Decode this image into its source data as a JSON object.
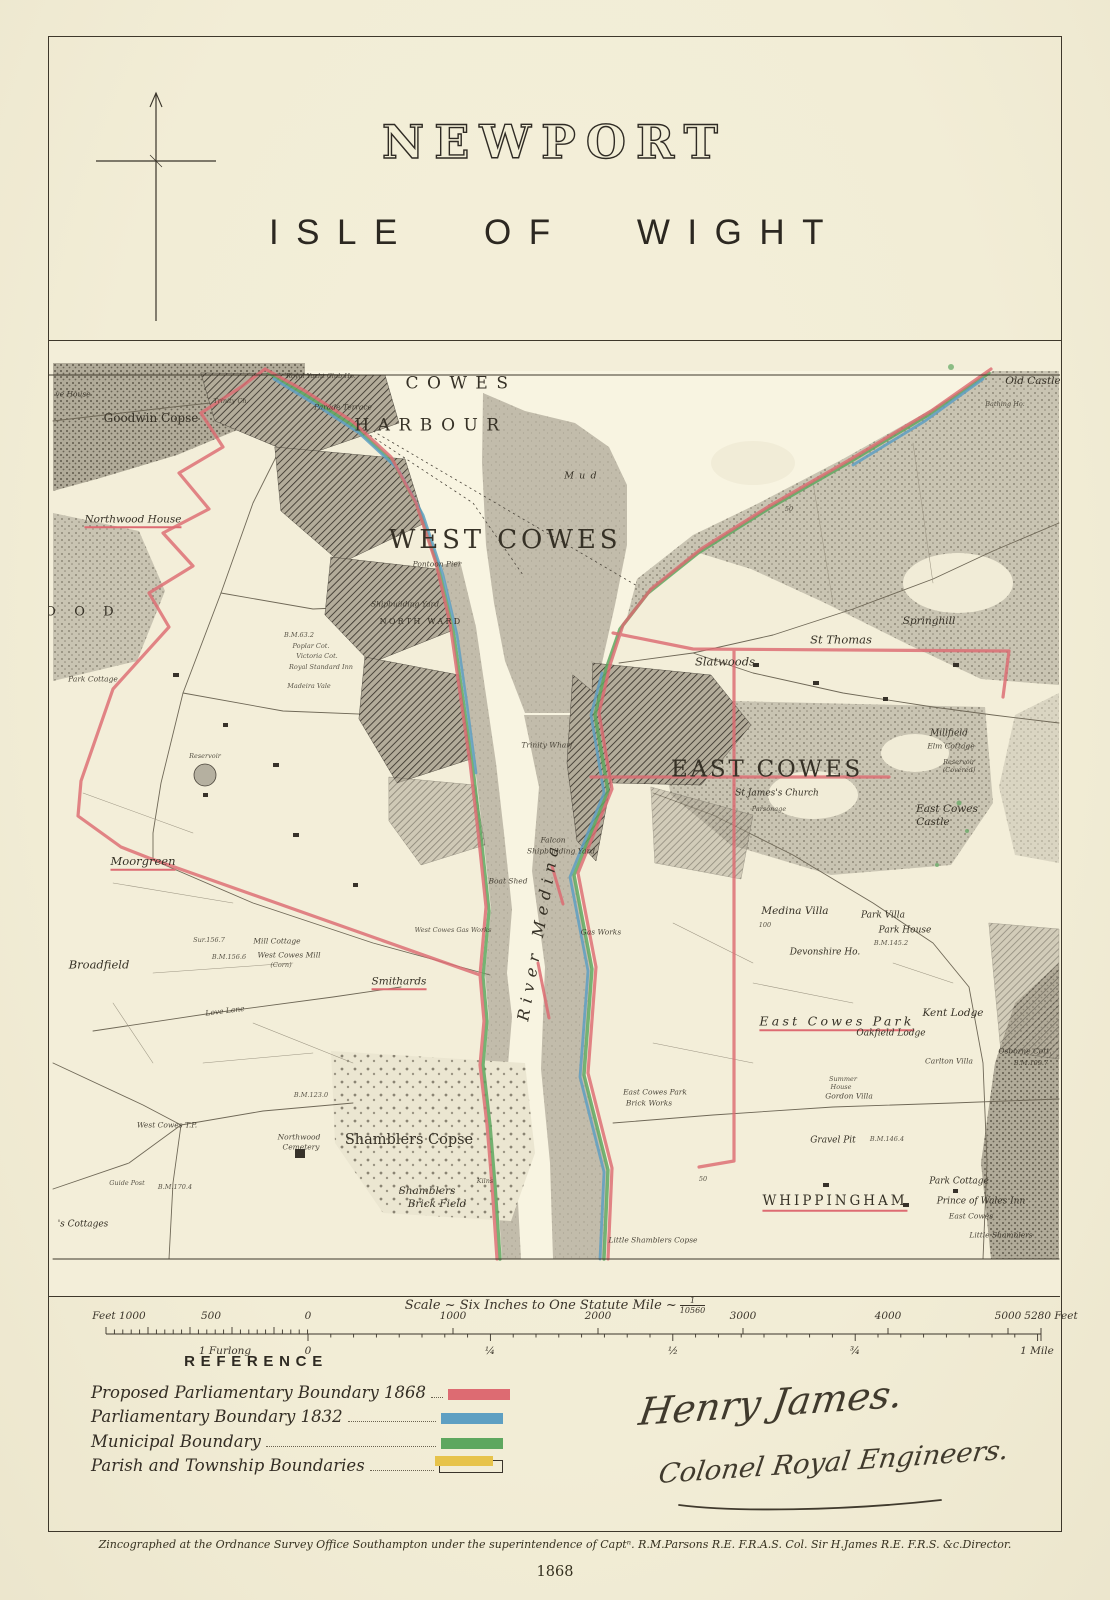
{
  "title_block": {
    "title": "NEWPORT",
    "subtitle": "ISLE OF WIGHT"
  },
  "map": {
    "colors": {
      "red": "#dd6b72",
      "blue": "#5e9fc2",
      "green": "#5ea75f",
      "yellow": "#e7c34a",
      "ink": "#3a342a",
      "water": "#f8f4e1",
      "mud": "#c2bcab",
      "woodland": "#c9c4b2"
    },
    "labels": [
      {
        "text": "Royal Yacht Club Ho.",
        "x": 268,
        "y": 13,
        "cls": "t6"
      },
      {
        "text": "Parade Terrace",
        "x": 290,
        "y": 44,
        "cls": "t7"
      },
      {
        "text": "COWES",
        "x": 408,
        "y": 21,
        "cls": "big17"
      },
      {
        "text": "HARBOUR",
        "x": 378,
        "y": 63,
        "cls": "big17"
      },
      {
        "text": "Mud",
        "x": 530,
        "y": 113,
        "cls": "t8s"
      },
      {
        "text": "WEST COWES",
        "x": 452,
        "y": 177,
        "cls": "big27"
      },
      {
        "text": "Pontoon Pier",
        "x": 384,
        "y": 201,
        "cls": "t7"
      },
      {
        "text": "Shipbuilding Yard",
        "x": 352,
        "y": 241,
        "cls": "t7"
      },
      {
        "text": "NORTH WARD",
        "x": 368,
        "y": 259,
        "cls": "cap8"
      },
      {
        "text": "B.M.63.2",
        "x": 246,
        "y": 272,
        "cls": "t6"
      },
      {
        "text": "Poplar Cot.",
        "x": 258,
        "y": 283,
        "cls": "t6"
      },
      {
        "text": "Victoria Cot.",
        "x": 264,
        "y": 293,
        "cls": "t6"
      },
      {
        "text": "Royal Standard Inn",
        "x": 268,
        "y": 304,
        "cls": "t6"
      },
      {
        "text": "Madeira Vale",
        "x": 256,
        "y": 323,
        "cls": "t6"
      },
      {
        "text": "Old Castle",
        "x": 980,
        "y": 18,
        "cls": "it10"
      },
      {
        "text": "Bathing Ho.",
        "x": 952,
        "y": 41,
        "cls": "t6"
      },
      {
        "text": "ve House",
        "x": 20,
        "y": 31,
        "cls": "t7"
      },
      {
        "text": "Goodwin Copse",
        "x": 98,
        "y": 55,
        "cls": "md12"
      },
      {
        "text": "Trinity Ch.",
        "x": 178,
        "y": 38,
        "cls": "t6"
      },
      {
        "text": "Northwood House",
        "x": 80,
        "y": 158,
        "cls": "it10",
        "u": 1
      },
      {
        "text": "O O D",
        "x": 30,
        "y": 249,
        "cls": "md13sp"
      },
      {
        "text": "Park Cottage",
        "x": 40,
        "y": 316,
        "cls": "t7"
      },
      {
        "text": "Reservoir",
        "x": 152,
        "y": 393,
        "cls": "t6"
      },
      {
        "text": "Moorgreen",
        "x": 90,
        "y": 500,
        "cls": "it11",
        "u": 1
      },
      {
        "text": "Broadfield",
        "x": 46,
        "y": 602,
        "cls": "it11"
      },
      {
        "text": "Sur.156.7",
        "x": 156,
        "y": 577,
        "cls": "t6"
      },
      {
        "text": "Mill Cottage",
        "x": 224,
        "y": 578,
        "cls": "t7"
      },
      {
        "text": "B.M.156.6",
        "x": 176,
        "y": 594,
        "cls": "t6"
      },
      {
        "text": "West Cowes Mill",
        "x": 236,
        "y": 592,
        "cls": "t7"
      },
      {
        "text": "(Corn)",
        "x": 228,
        "y": 602,
        "cls": "t6"
      },
      {
        "text": "Smithards",
        "x": 346,
        "y": 620,
        "cls": "it10",
        "u": 1
      },
      {
        "text": "Love Lane",
        "x": 172,
        "y": 648,
        "cls": "t7",
        "rot": -7
      },
      {
        "text": "West Cowes T.P.",
        "x": 114,
        "y": 762,
        "cls": "t7"
      },
      {
        "text": "B.M.123.0",
        "x": 258,
        "y": 732,
        "cls": "t6"
      },
      {
        "text": "Guide Post",
        "x": 74,
        "y": 820,
        "cls": "t6"
      },
      {
        "text": "B.M.170.4",
        "x": 122,
        "y": 824,
        "cls": "t6"
      },
      {
        "text": "Shamblers Copse",
        "x": 356,
        "y": 777,
        "cls": "md14"
      },
      {
        "text": "Northwood",
        "x": 246,
        "y": 774,
        "cls": "t7"
      },
      {
        "text": "Cemetery",
        "x": 248,
        "y": 784,
        "cls": "t7"
      },
      {
        "text": "Shamblers",
        "x": 374,
        "y": 828,
        "cls": "it10"
      },
      {
        "text": "Brick Field",
        "x": 384,
        "y": 841,
        "cls": "it10"
      },
      {
        "text": "Kilns",
        "x": 432,
        "y": 818,
        "cls": "t6"
      },
      {
        "text": "'s Cottages",
        "x": 30,
        "y": 862,
        "cls": "it9"
      },
      {
        "text": "Little Shamblers Copse",
        "x": 600,
        "y": 877,
        "cls": "t7"
      },
      {
        "text": "River Medina",
        "x": 486,
        "y": 568,
        "cls": "riv",
        "rot": -80
      },
      {
        "text": "Trinity Wharf",
        "x": 494,
        "y": 382,
        "cls": "t7"
      },
      {
        "text": "Falcon",
        "x": 500,
        "y": 477,
        "cls": "t7"
      },
      {
        "text": "Shipbuilding Yard",
        "x": 508,
        "y": 488,
        "cls": "t7"
      },
      {
        "text": "Boat Shed",
        "x": 455,
        "y": 518,
        "cls": "t7"
      },
      {
        "text": "West Cowes Gas Works",
        "x": 400,
        "y": 567,
        "cls": "t6"
      },
      {
        "text": "Gas Works",
        "x": 548,
        "y": 569,
        "cls": "t7"
      },
      {
        "text": "EAST COWES",
        "x": 714,
        "y": 407,
        "cls": "big24"
      },
      {
        "text": "St James's Church",
        "x": 724,
        "y": 431,
        "cls": "it9"
      },
      {
        "text": "Parsonage",
        "x": 716,
        "y": 446,
        "cls": "t6"
      },
      {
        "text": "Slatwoods",
        "x": 672,
        "y": 299,
        "cls": "it11"
      },
      {
        "text": "St Thomas",
        "x": 788,
        "y": 277,
        "cls": "it11"
      },
      {
        "text": "Springhill",
        "x": 876,
        "y": 258,
        "cls": "it10"
      },
      {
        "text": "Millfield",
        "x": 896,
        "y": 371,
        "cls": "it9"
      },
      {
        "text": "Elm Cottage",
        "x": 898,
        "y": 383,
        "cls": "t7"
      },
      {
        "text": "Reservoir",
        "x": 906,
        "y": 399,
        "cls": "t6"
      },
      {
        "text": "(Covered)",
        "x": 906,
        "y": 407,
        "cls": "t6"
      },
      {
        "text": "East Cowes",
        "x": 894,
        "y": 446,
        "cls": "it10"
      },
      {
        "text": "Castle",
        "x": 880,
        "y": 459,
        "cls": "it10"
      },
      {
        "text": "50",
        "x": 736,
        "y": 146,
        "cls": "t6"
      },
      {
        "text": "Medina Villa",
        "x": 742,
        "y": 548,
        "cls": "it10"
      },
      {
        "text": "100",
        "x": 712,
        "y": 562,
        "cls": "t6"
      },
      {
        "text": "Park Villa",
        "x": 830,
        "y": 553,
        "cls": "it9"
      },
      {
        "text": "Park House",
        "x": 852,
        "y": 568,
        "cls": "it9"
      },
      {
        "text": "B.M.145.2",
        "x": 838,
        "y": 580,
        "cls": "t6"
      },
      {
        "text": "Devonshire Ho.",
        "x": 772,
        "y": 590,
        "cls": "it9"
      },
      {
        "text": "East Cowes Park",
        "x": 784,
        "y": 660,
        "cls": "it13sp",
        "u": 1
      },
      {
        "text": "Oakfield Lodge",
        "x": 838,
        "y": 671,
        "cls": "it9"
      },
      {
        "text": "Kent Lodge",
        "x": 900,
        "y": 650,
        "cls": "it10"
      },
      {
        "text": "Summer",
        "x": 790,
        "y": 716,
        "cls": "t6"
      },
      {
        "text": "House",
        "x": 788,
        "y": 724,
        "cls": "t6"
      },
      {
        "text": "Carlton Villa",
        "x": 896,
        "y": 698,
        "cls": "t7"
      },
      {
        "text": "Osborne Cott.",
        "x": 972,
        "y": 688,
        "cls": "t7"
      },
      {
        "text": "B.M.109.7",
        "x": 978,
        "y": 700,
        "cls": "t6"
      },
      {
        "text": "Gordon Villa",
        "x": 796,
        "y": 733,
        "cls": "t7"
      },
      {
        "text": "Gravel Pit",
        "x": 780,
        "y": 778,
        "cls": "it9"
      },
      {
        "text": "B.M.146.4",
        "x": 834,
        "y": 776,
        "cls": "t6"
      },
      {
        "text": "50",
        "x": 650,
        "y": 816,
        "cls": "t6"
      },
      {
        "text": "WHIPPINGHAM",
        "x": 782,
        "y": 840,
        "cls": "cap13",
        "u": 1
      },
      {
        "text": "Park Cottage",
        "x": 906,
        "y": 819,
        "cls": "it9"
      },
      {
        "text": "Prince of Wales Inn",
        "x": 928,
        "y": 839,
        "cls": "it9"
      },
      {
        "text": "East Cowes",
        "x": 918,
        "y": 853,
        "cls": "t7"
      },
      {
        "text": "East Cowes Park",
        "x": 602,
        "y": 729,
        "cls": "t7"
      },
      {
        "text": "Brick Works",
        "x": 596,
        "y": 740,
        "cls": "t7"
      },
      {
        "text": "Little Shamblers",
        "x": 948,
        "y": 872,
        "cls": "t7"
      }
    ]
  },
  "scale": {
    "title_main": "Scale ~ Six Inches to One Statute Mile ~",
    "fraction_num": "1",
    "fraction_den": "10560",
    "feet_top": [
      {
        "t": "Feet 1000",
        "x": 70
      },
      {
        "t": "500",
        "x": 162
      },
      {
        "t": "0",
        "x": 259
      },
      {
        "t": "1000",
        "x": 404
      },
      {
        "t": "2000",
        "x": 549
      },
      {
        "t": "3000",
        "x": 694
      },
      {
        "t": "4000",
        "x": 839
      },
      {
        "t": "5000",
        "x": 959
      },
      {
        "t": "5280 Feet",
        "x": 1002
      }
    ],
    "miles_bottom": [
      {
        "t": "1 Furlong",
        "x": 176
      },
      {
        "t": "0",
        "x": 259
      },
      {
        "t": "¼",
        "x": 441
      },
      {
        "t": "½",
        "x": 624
      },
      {
        "t": "¾",
        "x": 806
      },
      {
        "t": "1 Mile",
        "x": 988
      }
    ]
  },
  "reference": {
    "heading": "REFERENCE",
    "items": [
      {
        "label": "Proposed Parliamentary Boundary 1868",
        "color": "#dd6b72",
        "style": "solid"
      },
      {
        "label": "Parliamentary Boundary 1832",
        "color": "#5e9fc2",
        "style": "solid"
      },
      {
        "label": "Municipal Boundary",
        "color": "#5ea75f",
        "style": "solid"
      },
      {
        "label": "Parish and Township Boundaries",
        "color": "#e7c34a",
        "style": "offset-outline"
      }
    ]
  },
  "signature": {
    "line1": "Henry James.",
    "line2": "Colonel Royal Engineers."
  },
  "footer": {
    "imprint": "Zincographed at the Ordnance Survey Office Southampton under the superintendence of Captⁿ. R.M.Parsons R.E. F.R.A.S. Col. Sir H.James R.E. F.R.S. &c.Director.",
    "year": "1868"
  }
}
